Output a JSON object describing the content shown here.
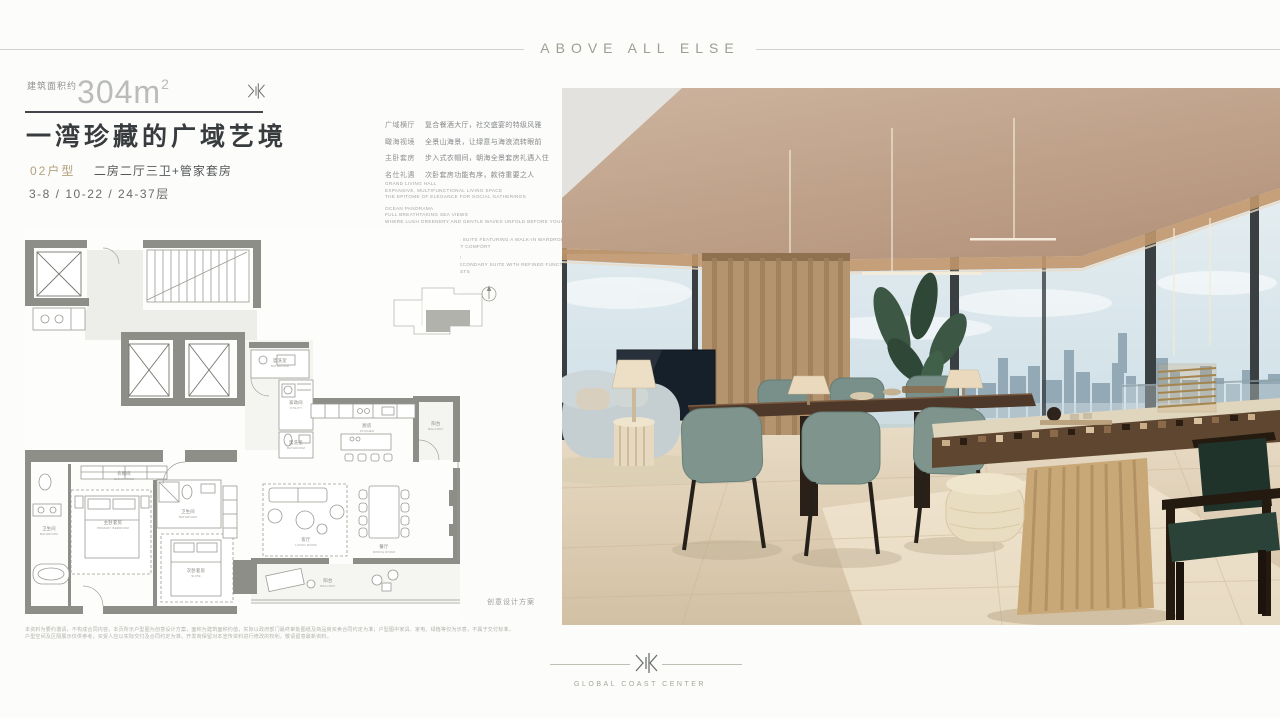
{
  "header": {
    "tagline": "ABOVE ALL ELSE"
  },
  "intro": {
    "area_prefix": "建筑面积约",
    "area_value": "304m",
    "area_exp": "2",
    "title": "一湾珍藏的广域艺境",
    "unit_code": "02户型",
    "unit_desc": "二房二厅三卫+管家套房",
    "floors": "3-8 / 10-22 / 24-37层"
  },
  "features": [
    {
      "label": "广域横厅",
      "text": "复合餐酒大厅，社交盛宴的特级风雅"
    },
    {
      "label": "瞰海视境",
      "text": "全景山海景，让绿意与海浪流转眼前"
    },
    {
      "label": "主卧套房",
      "text": "步入式衣帽间，朝海全景套房礼遇入住"
    },
    {
      "label": "名仕礼遇",
      "text": "次卧套房功能有序，款待重要之人"
    }
  ],
  "features_en": [
    {
      "l1": "GRAND LIVING HALL",
      "l2": "EXPANSIVE, MULTIFUNCTIONAL LIVING SPACE",
      "l3": "THE EPITOME OF ELEGANCE FOR SOCIAL GATHERINGS"
    },
    {
      "l1": "OCEAN PANORAMA",
      "l2": "FULL BREATHTAKING SEA VIEWS",
      "l3": "WHERE LUSH GREENERY AND GENTLE WAVES UNFOLD BEFORE YOUR EYES"
    },
    {
      "l1": "MASTER SUITE SANCTUARY",
      "l2": "A PANORAMIC SOUTH-FACING SUITE FEATURING A WALK-IN WARDROBE",
      "l3": "EMBRACING THE SEA IN QUIET COMFORT"
    },
    {
      "l1": "DISTINGUISHED GUEST SUITE",
      "l2": "THOUGHTFULLY DESIGNED SECONDARY SUITE WITH REFINED FUNCTIONALITY",
      "l3": "TO WELCOME HONORED GUESTS"
    }
  ],
  "plan": {
    "note": "创意设计方案",
    "rooms": [
      {
        "cn": "衣帽间",
        "en": "CLOAKROOM"
      },
      {
        "cn": "主卧套房",
        "en": "PRIMARY BEDROOM"
      },
      {
        "cn": "卫生间",
        "en": "BATHROOM"
      },
      {
        "cn": "次卧套房",
        "en": "SUITE"
      },
      {
        "cn": "卫生间",
        "en": "BATHROOM"
      },
      {
        "cn": "盥洗室",
        "en": "BATHROOM"
      },
      {
        "cn": "家政间",
        "en": "UTILITY"
      },
      {
        "cn": "盥洗室",
        "en": "BATHROOM"
      },
      {
        "cn": "厨房",
        "en": "KITCHEN"
      },
      {
        "cn": "阳台",
        "en": "BALCONY"
      },
      {
        "cn": "客厅",
        "en": "LIVING ROOM"
      },
      {
        "cn": "餐厅",
        "en": "DINING ROOM"
      },
      {
        "cn": "阳台",
        "en": "BALCONY"
      }
    ]
  },
  "disclaimer": {
    "line1": "本资料为要约邀请，不构成合同内容。本页所示户型图为创意设计方案，面积为建筑面积约值，实际以政府部门最终审批图纸及商品房买卖合同约定为准；户型图中家具、家电、绿植等仅为示意，不属于交付标准。",
    "line2": "户型空间及区隔展示仅供参考，买受人应以实际交付及合同约定为准。开发商保留对本宣传资料进行修改的权利，敬请留意最新资料。"
  },
  "footer": {
    "brand": "GLOBAL COAST CENTER"
  },
  "colors": {
    "accent_gold": "#b3a17f",
    "tagline_gray": "#9ba093",
    "ceiling_tan": "#bb9d83",
    "chair_teal": "#7e948c",
    "wall_gray": "#8e8e89"
  }
}
